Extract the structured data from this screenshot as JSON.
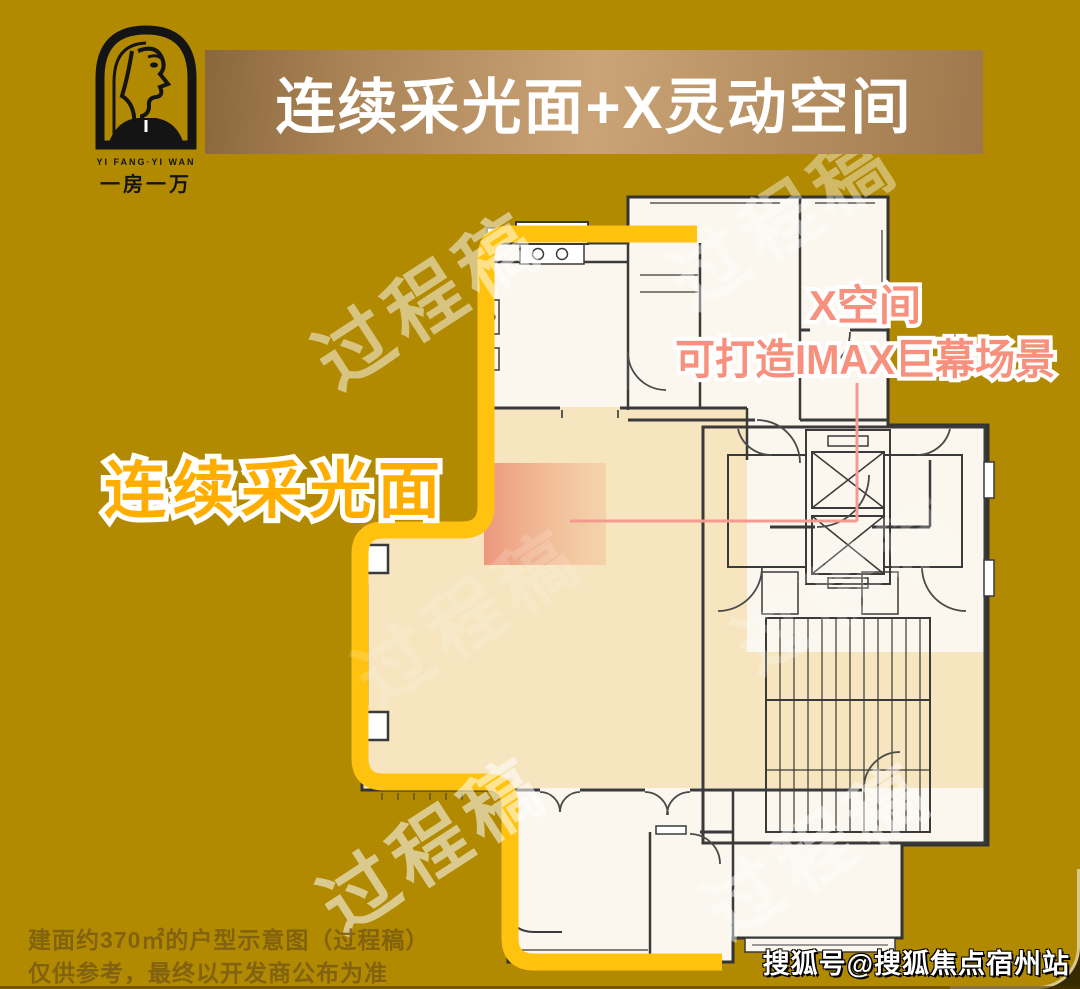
{
  "header": {
    "title": "连续采光面+X灵动空间"
  },
  "logo": {
    "brand_en": "YI FANG·YI WAN",
    "brand_cn": "一房一万"
  },
  "annotations": {
    "left_label": "连续采光面",
    "x_space_line1": "X空间",
    "x_space_line2": "可打造IMAX巨幕场景",
    "watermark": "过程稿"
  },
  "footer": {
    "disclaimer_line1": "建面约370㎡的户型示意图（过程稿）",
    "disclaimer_line2": "仅供参考，最终以开发商公布为准",
    "credit": "搜狐号@搜狐焦点宿州站"
  },
  "colors": {
    "background_gold": "#B18A02",
    "banner_bronze": "#CAA376",
    "outline_yellow": "#FFC30F",
    "highlight_cream": "#F5E4BA",
    "x_space_pink": "#EC9379",
    "left_label_orange": "#FFAE00",
    "pink_text": "#F7907C",
    "plan_paper": "#FBF7EE",
    "wall_ink": "#3A3A3A"
  }
}
